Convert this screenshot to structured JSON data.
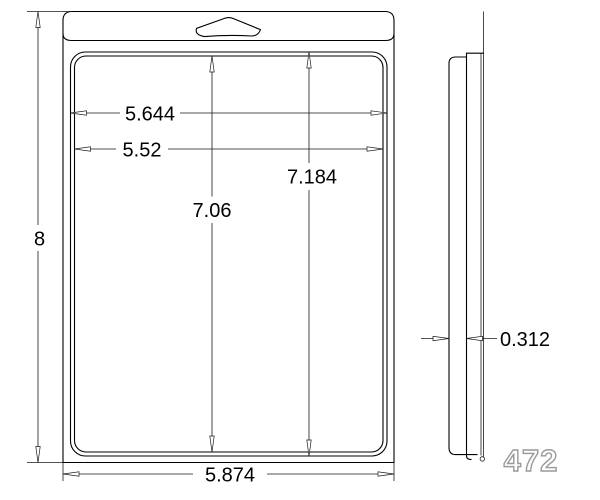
{
  "drawing": {
    "front_view": {
      "overall_height": "8",
      "flange_outer_width": "5.644",
      "flange_inner_width": "5.52",
      "flange_inner_height": "7.06",
      "flange_outer_height": "7.184",
      "overall_width": "5.874"
    },
    "side_view": {
      "depth": "0.312"
    },
    "part_number": "472"
  }
}
